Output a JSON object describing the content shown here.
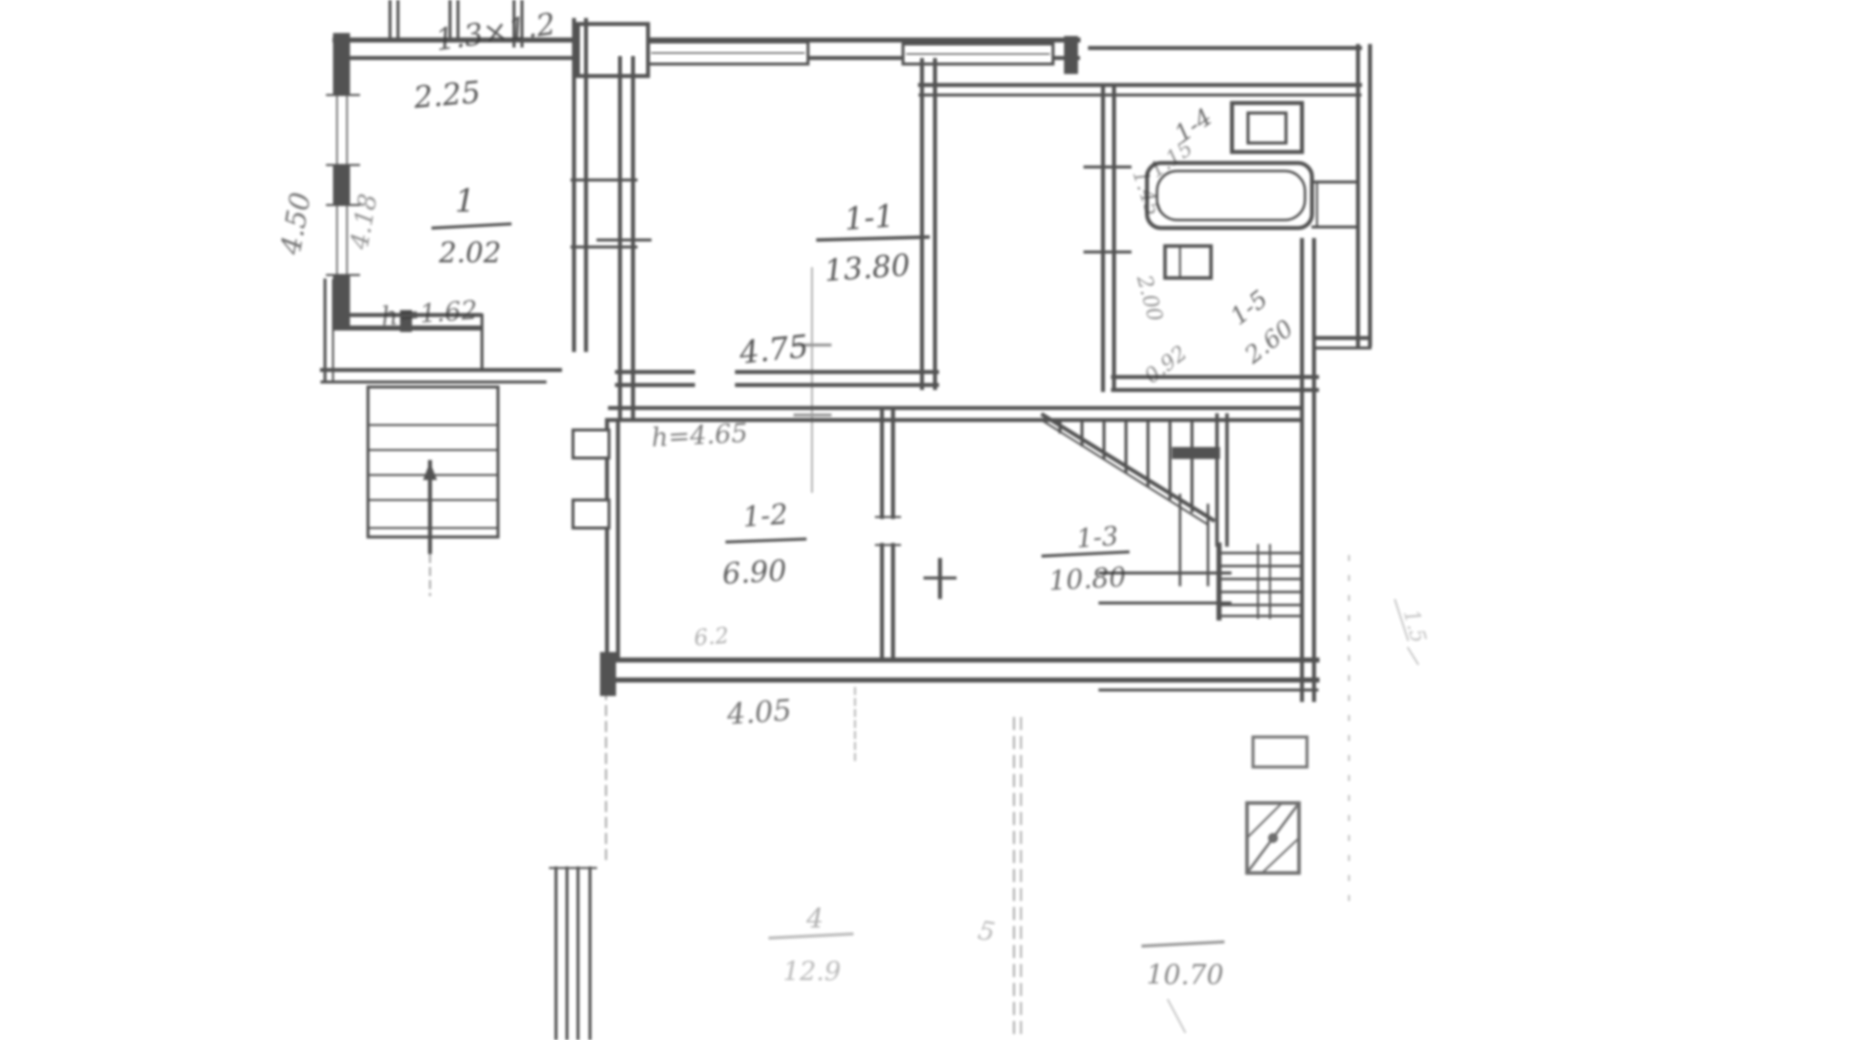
{
  "plan": {
    "title": "ground-floor plan (scanned hand drawing)",
    "rooms": {
      "hall": {
        "number": "1",
        "area": "2.02"
      },
      "living": {
        "number": "1-1",
        "area": "13.80"
      },
      "room2": {
        "number": "1-2",
        "area": "6.90"
      },
      "stair_hall": {
        "number": "1-3",
        "area": "10.80"
      },
      "bath": {
        "number": "1-4",
        "dim_a": "1.15",
        "dim_b": "1.45"
      },
      "kitchen": {
        "number": "1-5",
        "area": "2.60",
        "dim_vert": "2.00",
        "dim_diag": "0.92"
      },
      "terrace": {
        "number": "4",
        "area": "12.9"
      },
      "yard": {
        "area": "10.70",
        "mark": "5"
      }
    },
    "dimensions": {
      "chimney": "1.3×1.2",
      "hall_width": "2.25",
      "hall_left_outer": "4.50",
      "hall_left_inner": "4.18",
      "hall_door": "h=1.62",
      "living_width": "4.75",
      "room2_note": "h=4.65",
      "room2_small": "6.2",
      "band_width": "4.05",
      "right_margin": "1.5"
    }
  }
}
